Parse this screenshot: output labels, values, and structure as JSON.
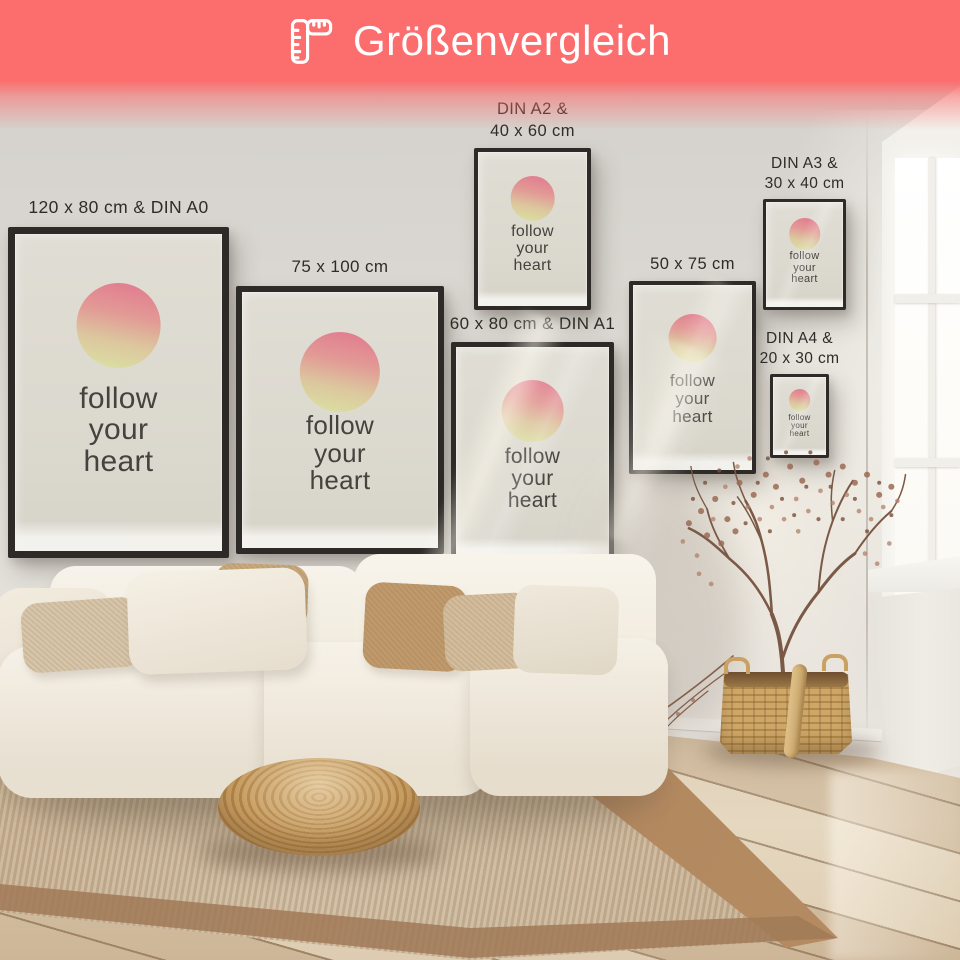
{
  "banner": {
    "title": "Größenvergleich",
    "icon": "ruler-icon",
    "background_color": "#FC6E6E",
    "text_color": "#FFFFFF"
  },
  "poster_quote": {
    "line1": "follow",
    "line2": "your",
    "line3": "heart"
  },
  "posters": [
    {
      "label": "120 x 80 cm & DIN A0"
    },
    {
      "label": "75 x 100 cm"
    },
    {
      "label": "DIN A2 &",
      "label2": "40 x 60 cm"
    },
    {
      "label": "60 x 80 cm & DIN A1"
    },
    {
      "label": "50 x 75 cm"
    },
    {
      "label": "DIN A3 &",
      "label2": "30 x 40 cm"
    },
    {
      "label": "DIN A4 &",
      "label2": "20 x 30 cm"
    }
  ],
  "colors": {
    "banner": "#FC6E6E",
    "poster_frame": "#2D2A27",
    "poster_background": "#DEDBD2",
    "circle_gradient_top": "#E1798F",
    "circle_gradient_bottom": "#DADFA2",
    "label_text": "#2E2C29"
  }
}
